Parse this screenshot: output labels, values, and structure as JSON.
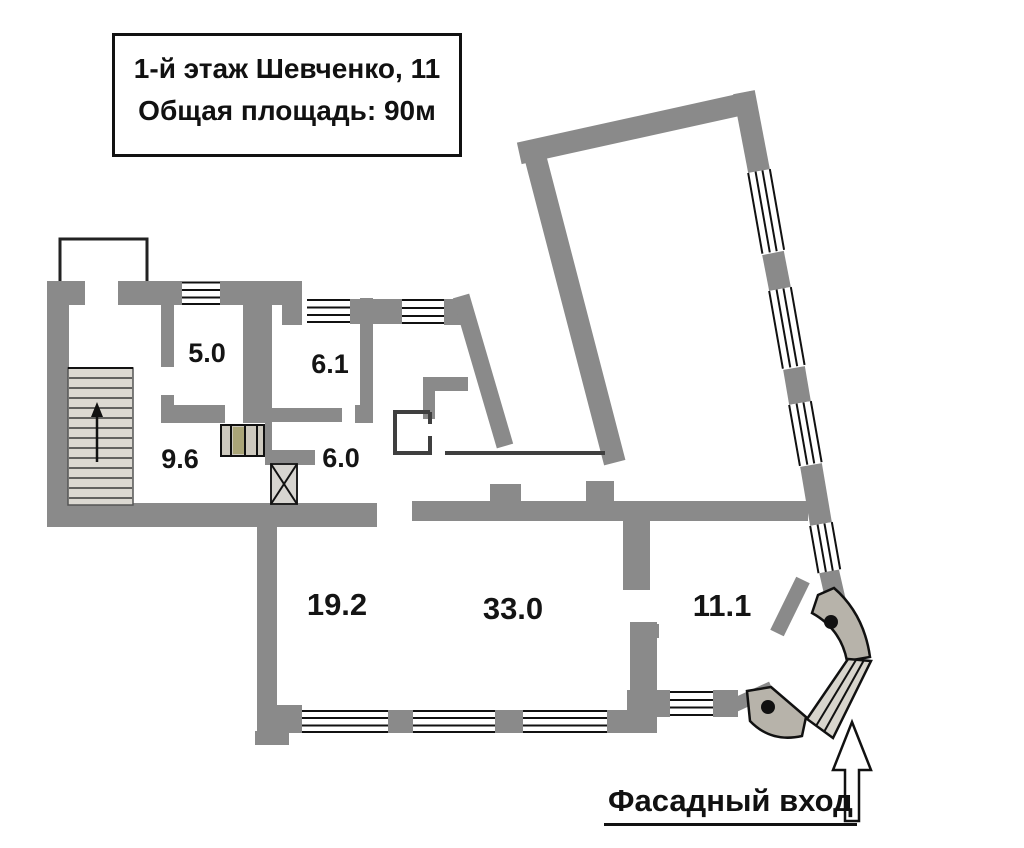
{
  "title_box": {
    "line1": "1-й этаж Шевченко, 11",
    "line2": "Общая площадь: 90м"
  },
  "rooms": [
    {
      "id": "room-5",
      "area": "5.0"
    },
    {
      "id": "room-6-1",
      "area": "6.1"
    },
    {
      "id": "stair-hall-9-6",
      "area": "9.6"
    },
    {
      "id": "corridor-6-0",
      "area": "6.0"
    },
    {
      "id": "room-19-2",
      "area": "19.2"
    },
    {
      "id": "room-33-0",
      "area": "33.0"
    },
    {
      "id": "room-11-1",
      "area": "11.1"
    }
  ],
  "entrance": {
    "label": "Фасадный вход",
    "arrow_direction": "up"
  },
  "stairs": {
    "arrow_direction": "up"
  },
  "colors": {
    "wall": "#8a8a8a",
    "window_line": "#111111",
    "thin_wall": "#3f3f3f",
    "stair_fill": "#dcd9d2",
    "pad_fill": "#b7b3aa",
    "accent_olive": "#aaa578",
    "background": "#ffffff"
  }
}
